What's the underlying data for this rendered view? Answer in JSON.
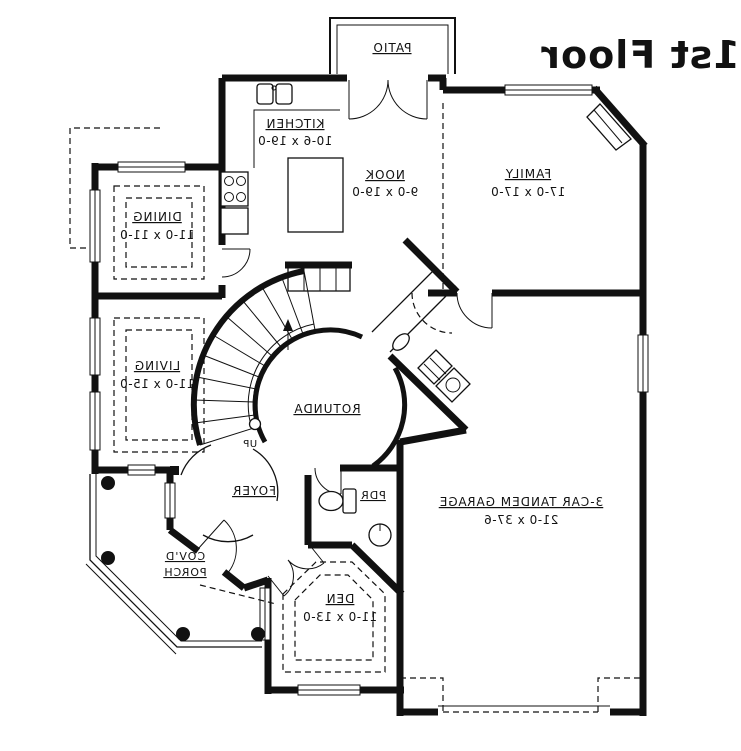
{
  "title": "1st Floor",
  "rooms": {
    "patio": {
      "name": "PATIO"
    },
    "kitchen": {
      "name": "KITCHEN",
      "dims": "10-6 x 19-0"
    },
    "nook": {
      "name": "NOOK",
      "dims": "9-0 x 19-0"
    },
    "family": {
      "name": "FAMILY",
      "dims": "17-0 x 17-0"
    },
    "dining": {
      "name": "DINING",
      "dims": "11-0 x 11-0"
    },
    "living": {
      "name": "LIVING",
      "dims": "11-0 x 15-0"
    },
    "rotunda": {
      "name": "ROTUNDA"
    },
    "foyer": {
      "name": "FOYER"
    },
    "powder": {
      "name": "PDR"
    },
    "den": {
      "name": "DEN",
      "dims": "11-0 x 13-0"
    },
    "garage": {
      "name": "3-CAR TANDEM GARAGE",
      "dims": "21-0 x 37-6"
    },
    "porch": {
      "line1": "COV'D",
      "line2": "PORCH"
    }
  },
  "annotations": {
    "stair_direction": "UP"
  },
  "colors": {
    "ink": "#111111",
    "background": "#ffffff"
  }
}
